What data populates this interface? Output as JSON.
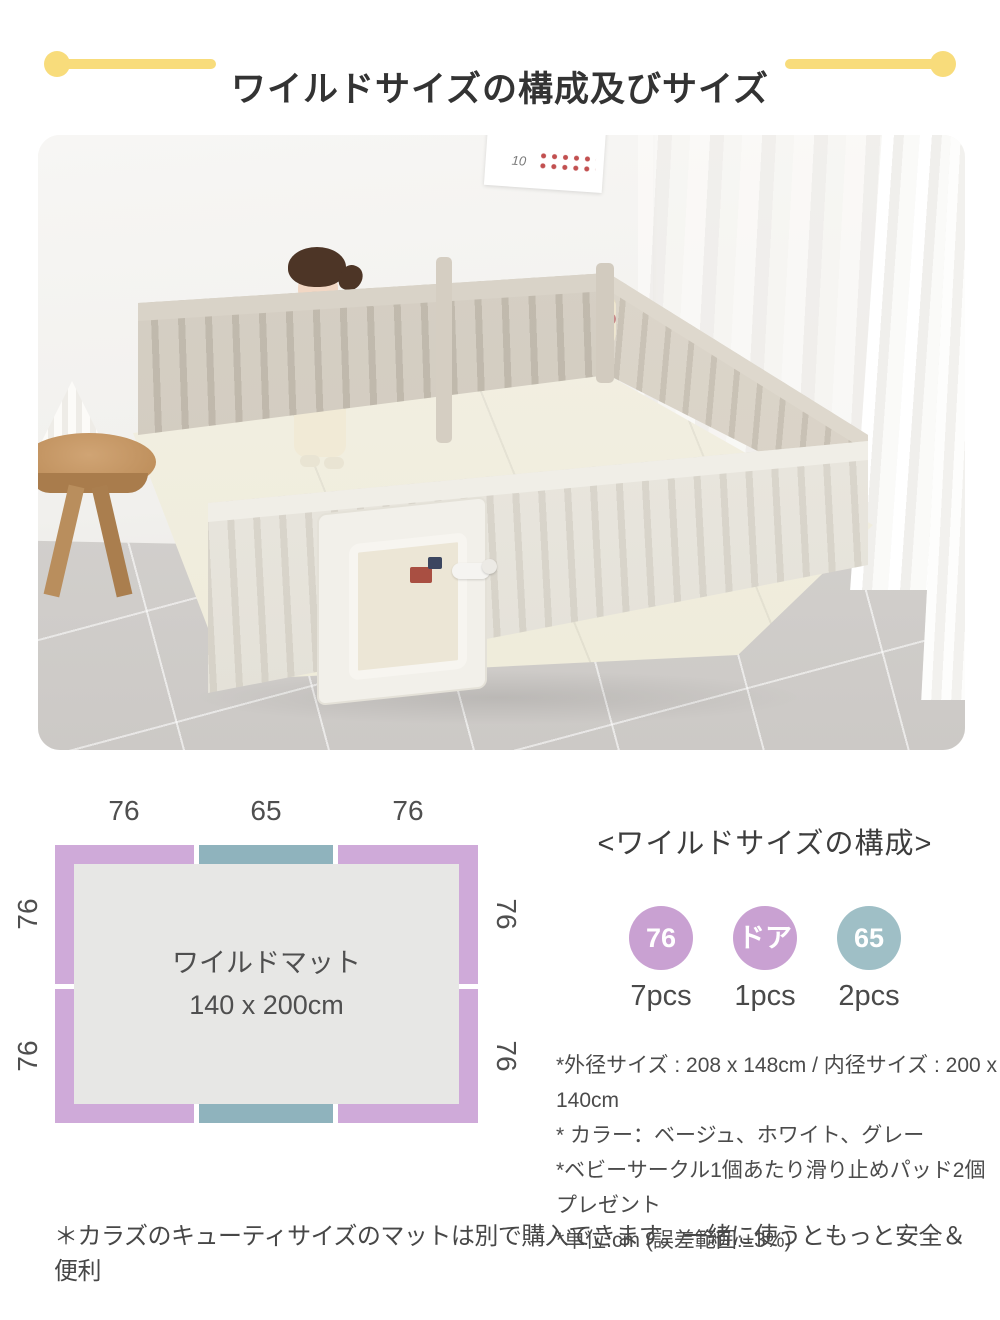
{
  "header": {
    "title": "ワイルドサイズの構成及びサイズ",
    "accent_color": "#f8dc7b"
  },
  "photo": {
    "calendar_number": "10"
  },
  "diagram": {
    "mat_label_line1": "ワイルドマット",
    "mat_label_line2": "140 x 200cm",
    "top_labels": [
      "76",
      "65",
      "76"
    ],
    "bottom_labels": [
      "76",
      "65",
      "76"
    ],
    "left_labels": [
      "76",
      "76"
    ],
    "right_labels": [
      "76",
      "76"
    ],
    "panel_color_76": "#cfaad9",
    "panel_color_65": "#8fb3bd",
    "mat_color": "#e7e7e5"
  },
  "composition": {
    "heading": "<ワイルドサイズの構成>",
    "items": [
      {
        "circle_label": "76",
        "count": "7pcs",
        "color": "#c9a1d2"
      },
      {
        "circle_label": "ドア",
        "count": "1pcs",
        "color": "#c9a1d2"
      },
      {
        "circle_label": "65",
        "count": "2pcs",
        "color": "#9fbfc6"
      }
    ]
  },
  "notes": [
    "*外径サイズ : 208 x 148cm / 内径サイズ : 200 x 140cm",
    "* カラー：ベージュ、ホワイト、グレー",
    "*ベビーサークル1個あたり滑り止めパッド2個プレゼント",
    "*単位:cm (誤差範囲:±3%)"
  ],
  "footer_note": "＊カラズのキューティサイズのマットは別で購入できます。一緒に使うともっと安全＆便利"
}
